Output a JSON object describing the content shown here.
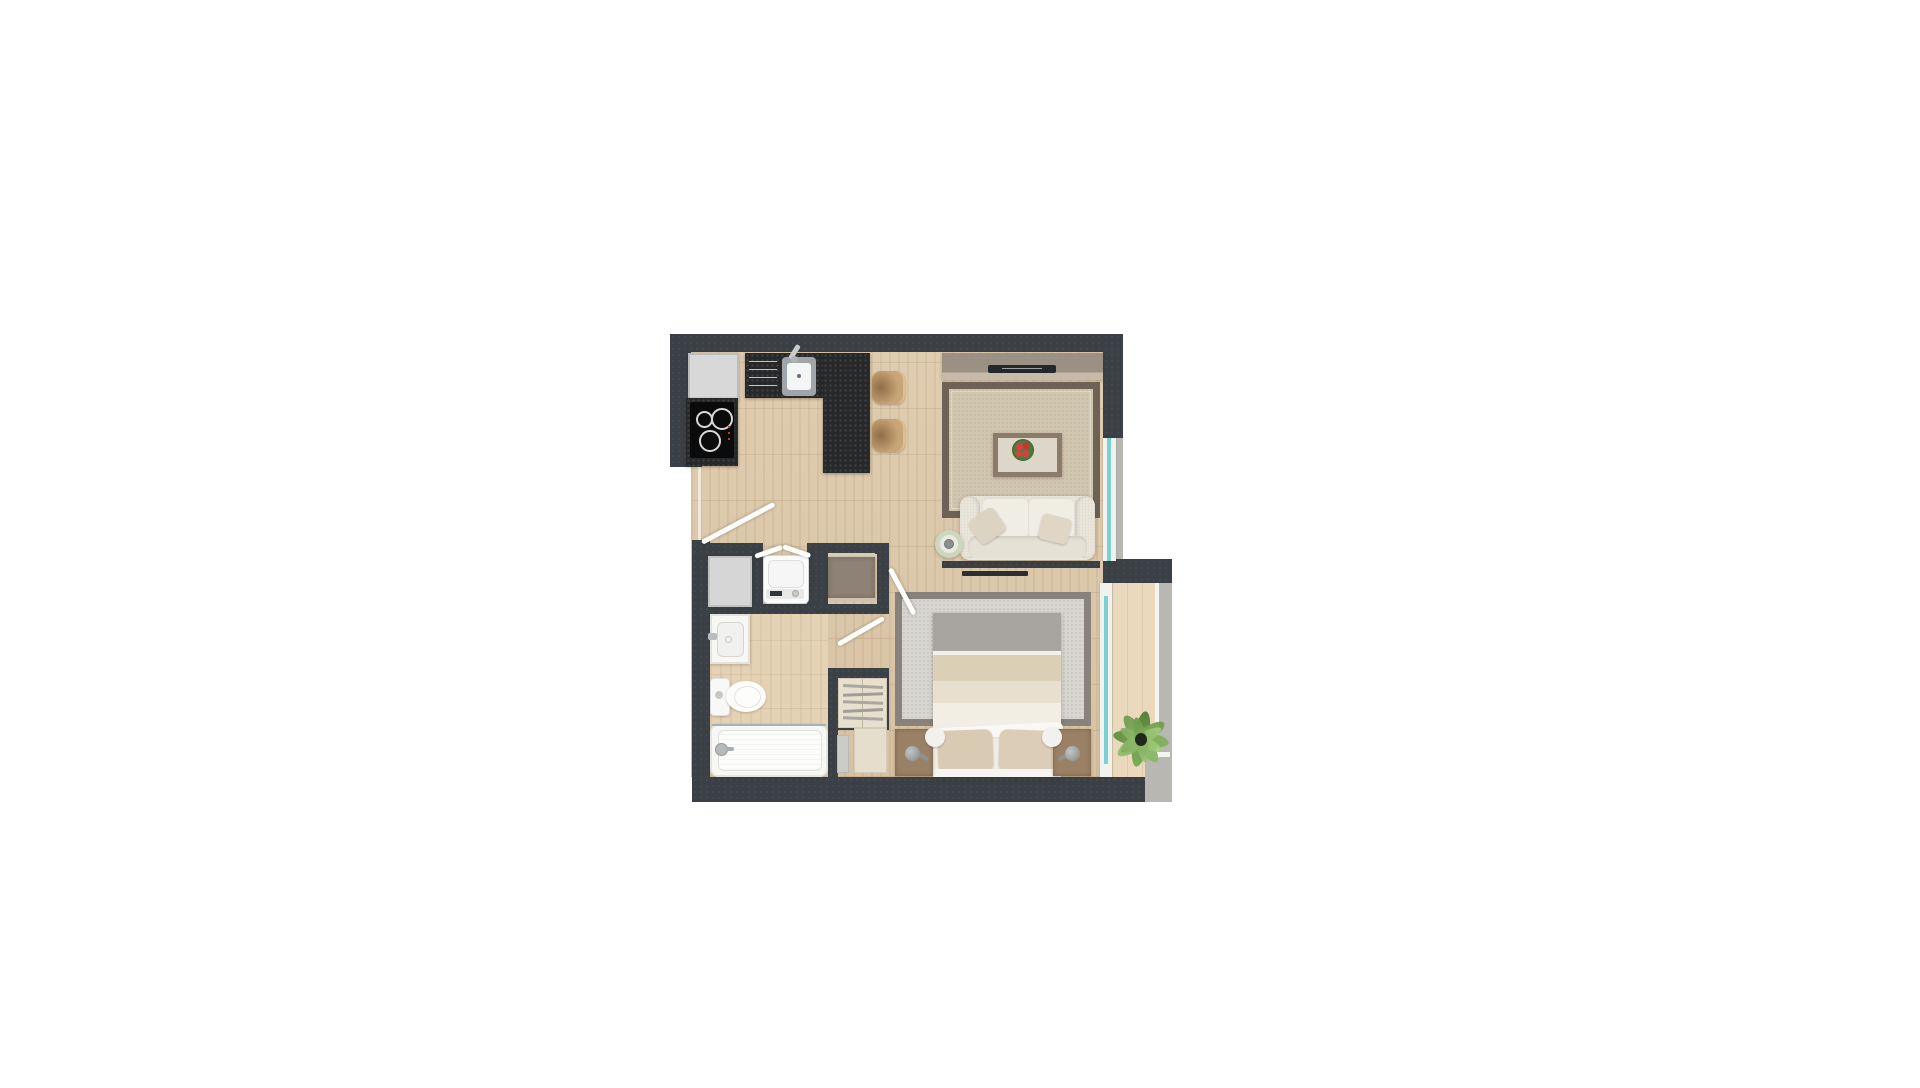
{
  "app": {
    "type": "architectural-floor-plan-render",
    "style": "top-down 3D color render, one-bedroom apartment",
    "background": "#ffffff",
    "visible_text": "none"
  },
  "palette": {
    "wall": "#3a4045",
    "kitchen_counter_granite": "#26282a",
    "floor_wood": "#dcc8aa",
    "floor_bathroom": "#e4d2b5",
    "floor_balcony": "#ead9bd",
    "window_glass": "#7ccfd3",
    "concrete_ledge": "#b9b7b1",
    "living_rug_field": "#d1c6b0",
    "living_rug_border": "#6e6156",
    "bedroom_rug_field": "#d7d6d0",
    "bedroom_rug_border": "#87827b",
    "sofa": "#eae6db",
    "bed_stripe_gray": "#a8a5a0",
    "bed_stripe_cream": "#dbcfb6",
    "bed_ivory": "#f2eee5",
    "pillow": "#d9cab4",
    "nightstand_wood": "#9a8165",
    "tv_console_wood": "#9c9083",
    "bar_stool": "#c8a476",
    "dresser": "#8e8276",
    "wardrobe_panel": "#e8e0cf",
    "appliance_white": "#fbfbfb",
    "fixture_white": "#f7f7f4",
    "plant_green": "#6f9c4c",
    "flower_red": "#c0392b",
    "door_leaf": "#fdfdfb"
  },
  "rooms": [
    {
      "id": "kitchen",
      "label": "Kitchen",
      "items": [
        "refrigerator",
        "granite-counter-with-sink",
        "drawer-unit",
        "cooktop-4-burner",
        "breakfast-bar",
        "bar-stool",
        "bar-stool"
      ]
    },
    {
      "id": "living-dining",
      "label": "Living / Dining",
      "items": [
        "tv-console",
        "flat-tv",
        "area-rug",
        "coffee-table-with-red-bouquet",
        "two-seat-sofa",
        "two-throw-pillows",
        "round-side-table"
      ]
    },
    {
      "id": "entry-hall",
      "label": "Entry Hall",
      "items": [
        "entry-door",
        "bifold-closet-doors",
        "washing-machine",
        "storage-cabinet",
        "dresser"
      ]
    },
    {
      "id": "bathroom",
      "label": "Bathroom",
      "items": [
        "washbasin",
        "toilet",
        "bathtub-with-faucet"
      ]
    },
    {
      "id": "bedroom",
      "label": "Bedroom",
      "items": [
        "double-bed-striped-duvet",
        "two-pillows",
        "area-rug",
        "nightstand-left",
        "nightstand-right",
        "table-lamps",
        "open-wardrobe-with-shelves",
        "wall-tv"
      ]
    },
    {
      "id": "balcony",
      "label": "Balcony",
      "items": [
        "potted-palm-plant",
        "glass-railing",
        "concrete-ledge"
      ]
    }
  ],
  "openings": {
    "entry_door": "left wall, swing leaf shown open",
    "closet_doors": "bifold pair above washing machine",
    "bedroom_door": "swing leaf at bedroom corner",
    "bathroom_door": "swing leaf into bedroom alcove",
    "windows": [
      "living-room right window",
      "bedroom-to-balcony glazing"
    ]
  }
}
